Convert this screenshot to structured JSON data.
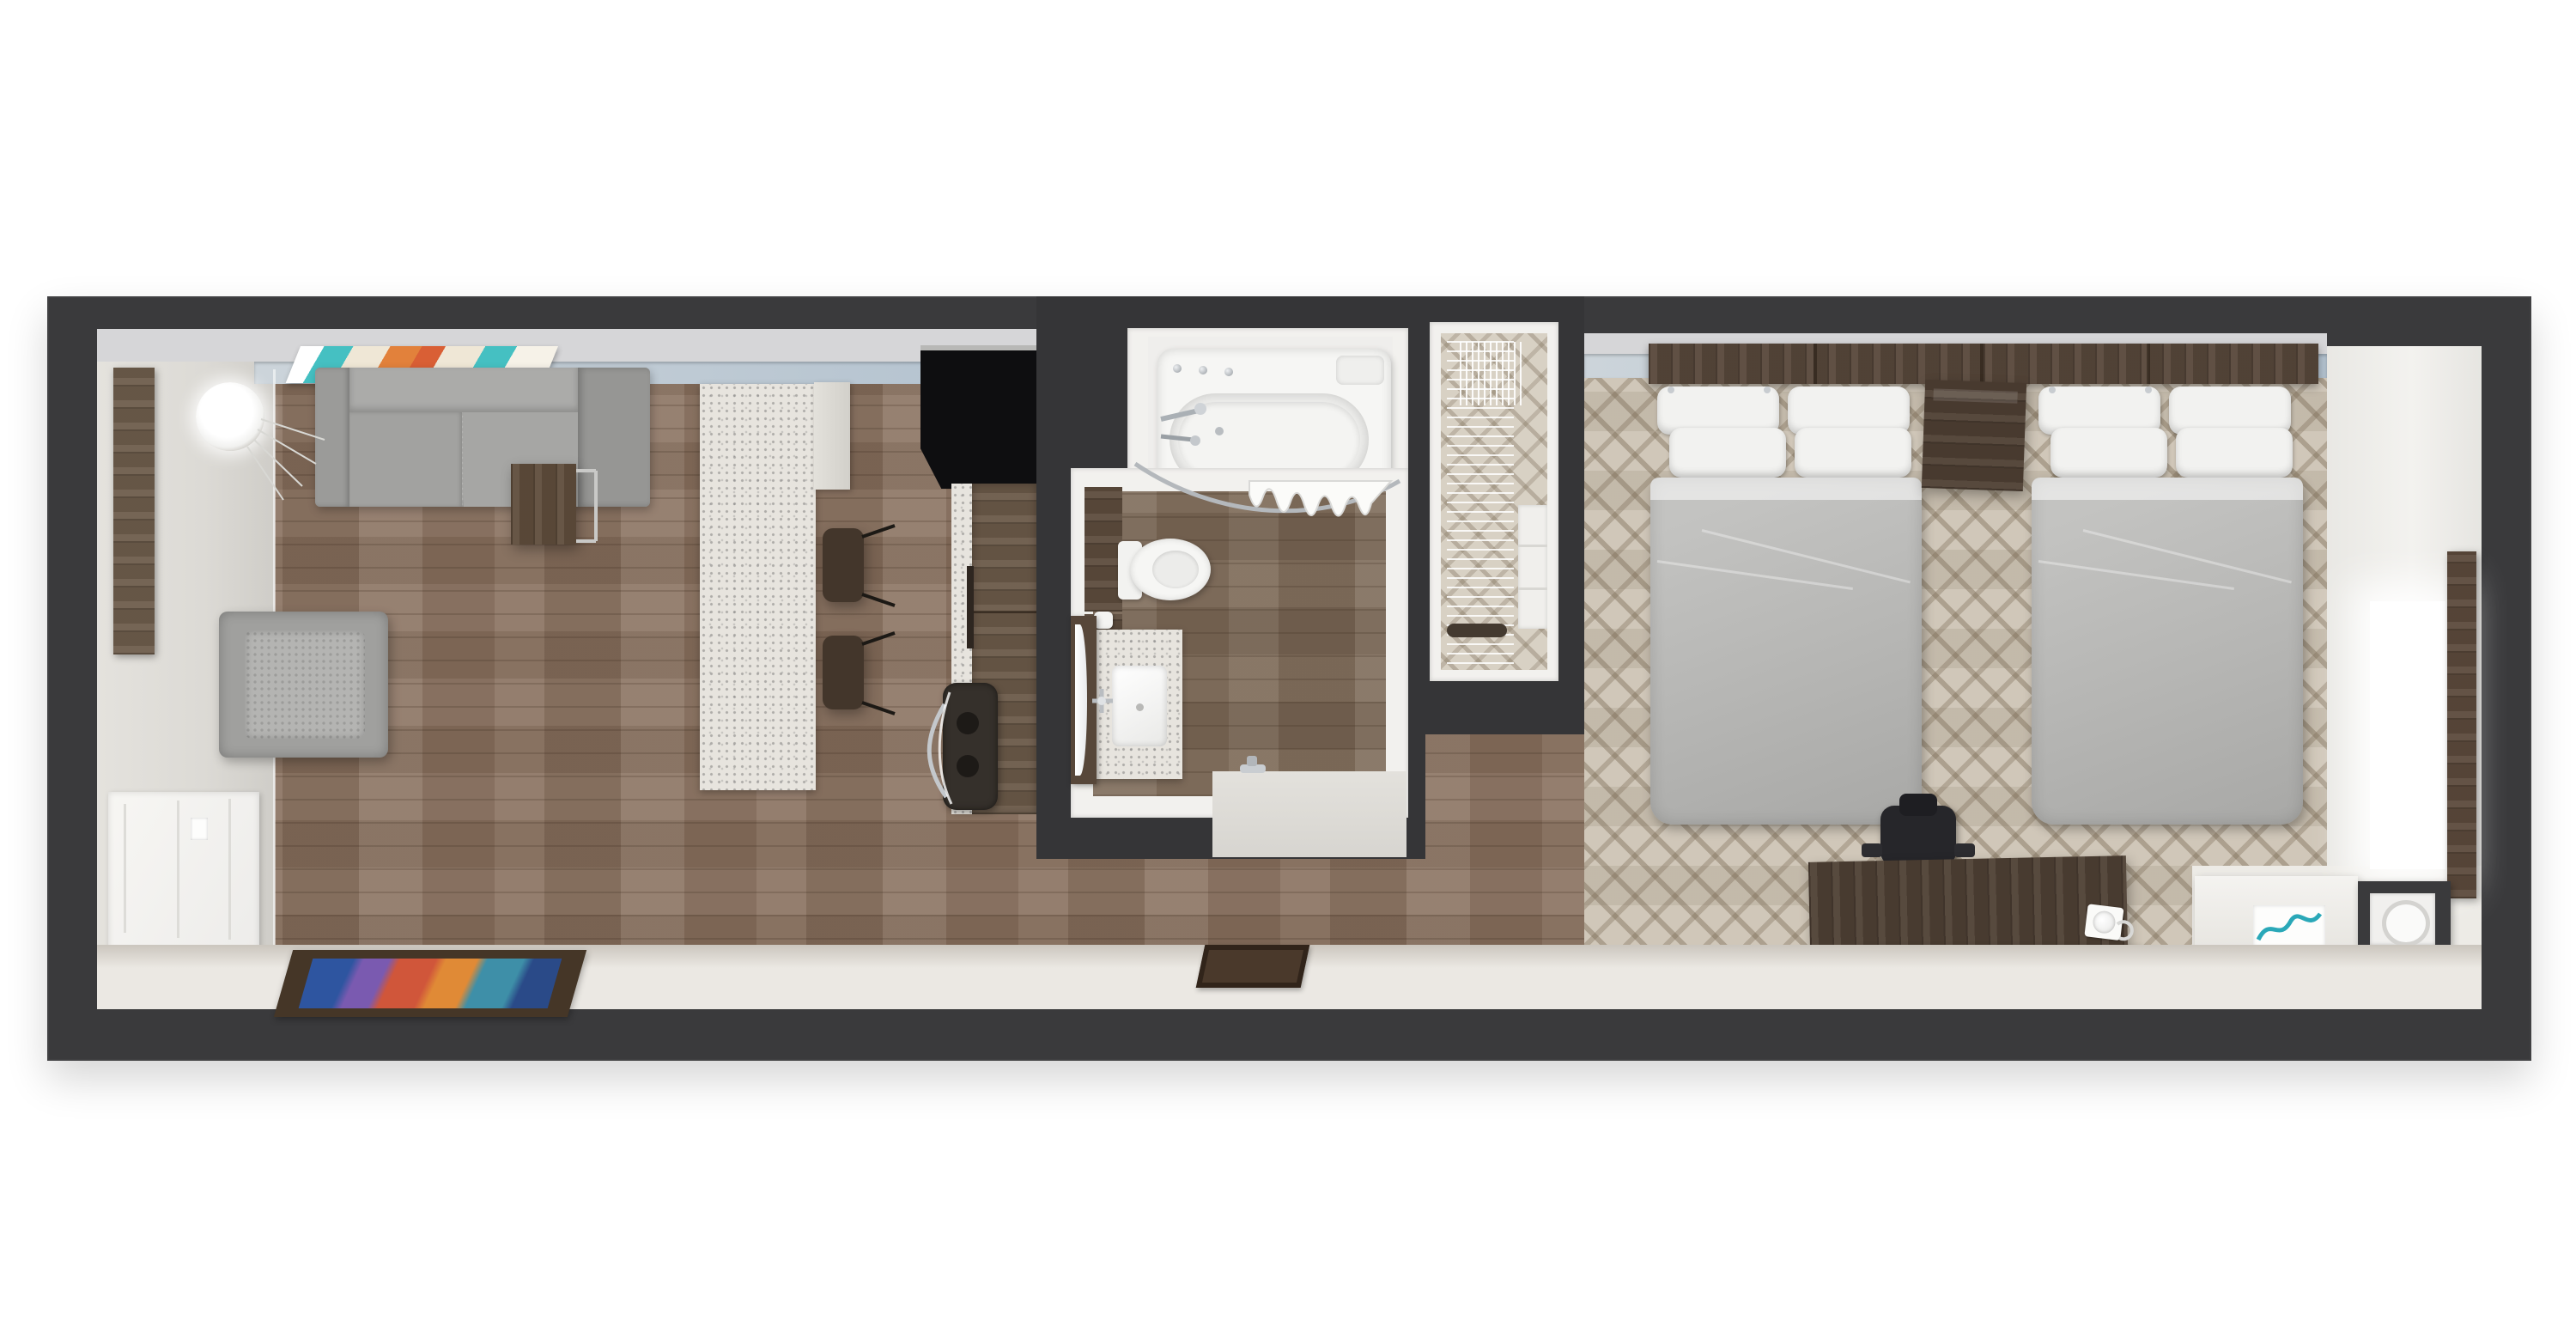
{
  "meta": {
    "image_kind": "3d-floorplan-top-down-render",
    "description": "Photoreal top-down 3D floor plan of a narrow hotel guest suite: living room with sectional sofa and kitchenette island on the left, central bathroom with tub, toilet and vanity, walk-in closet with wire shelving, and bedroom with two queen beds, work desk and mini-fridge nook on the right, connected by an entry walkway along the bottom.",
    "visible_text": []
  },
  "palette": {
    "page_bg": "#ffffff",
    "wall": "#3a3a3c",
    "wall_dark": "#353537",
    "top_wall": "#d6d6d8",
    "window_glow": "#b3c2cf",
    "window_glow_l": "#ccd4da",
    "left_wall": "#dcdad5",
    "white_wall": "#f2f1ee",
    "floor_wood": "#8a7260",
    "floor_wood_dark": "#7d6a58",
    "walkway": "#ebe8e3",
    "carpet": "#cbc1b1",
    "closet_floor": "#d8d1c4",
    "island": "#e7e4de",
    "black_counter": "#0e0e10",
    "cabinet_wood": "#6b5a49",
    "panel_wood": "#6e5d4c",
    "sofa": "#a4a4a2",
    "chaise": "#97979五",
    "armchair": "#a0a09e",
    "pillow": "#f2f2f0",
    "duvet": "#b6b6b4",
    "duvet_hi": "#c3c3c1",
    "headboard": "#57473a",
    "nightstand": "#4e3f33",
    "desk_wood": "#4e4034",
    "side_table": "#5f4d3c",
    "stool": "#43362b",
    "door_mat": "#4a392b",
    "desk_mat": "#3a2f26",
    "rug_border": "#453627",
    "chrome": "#b9bdc1",
    "tub_white": "#f6f6f4",
    "art_teal": "#45c0c2",
    "art_orange": "#e2813b",
    "art_cream": "#efe7d6",
    "art_rust": "#d95f35",
    "rug_blue": "#2e55a0",
    "rug_purple": "#7a5ab0",
    "rug_red": "#d0563a",
    "rug_amber": "#e08a36",
    "rug_teal": "#3e8fa8",
    "tablet_blue": "#3a6fd0",
    "tablet_pink": "#e0588a",
    "tablet_orange": "#f09a3e",
    "tablet_cyan": "#58c8d8",
    "credenza_art_teal": "#2aa8b8"
  },
  "scene": {
    "rooms": [
      {
        "id": "living-room",
        "furniture": [
          "sectional-sofa",
          "chaise",
          "side-table",
          "armchair",
          "pendant-lamp",
          "wall-art-abstract",
          "wood-wall-panel",
          "entry-door",
          "accent-rug"
        ]
      },
      {
        "id": "kitchenette",
        "furniture": [
          "island-counter",
          "upper-cabinet",
          "bar-stool",
          "bar-stool",
          "black-countertop",
          "base-cabinets",
          "sink"
        ]
      },
      {
        "id": "bathroom",
        "furniture": [
          "bathtub",
          "shower-curtain",
          "toilet",
          "vanity-sink",
          "leaning-mirror",
          "privacy-partition",
          "door-threshold"
        ]
      },
      {
        "id": "closet",
        "furniture": [
          "wire-shelving",
          "hanging-rod",
          "shelf-stack"
        ]
      },
      {
        "id": "bedroom",
        "furniture": [
          "queen-bed-1",
          "queen-bed-2",
          "nightstand",
          "headboard",
          "work-desk",
          "office-chair",
          "desk-mat-with-tablet",
          "window",
          "wall-mirror",
          "credenza",
          "mini-fridge-nook",
          "door-mat"
        ]
      }
    ]
  }
}
